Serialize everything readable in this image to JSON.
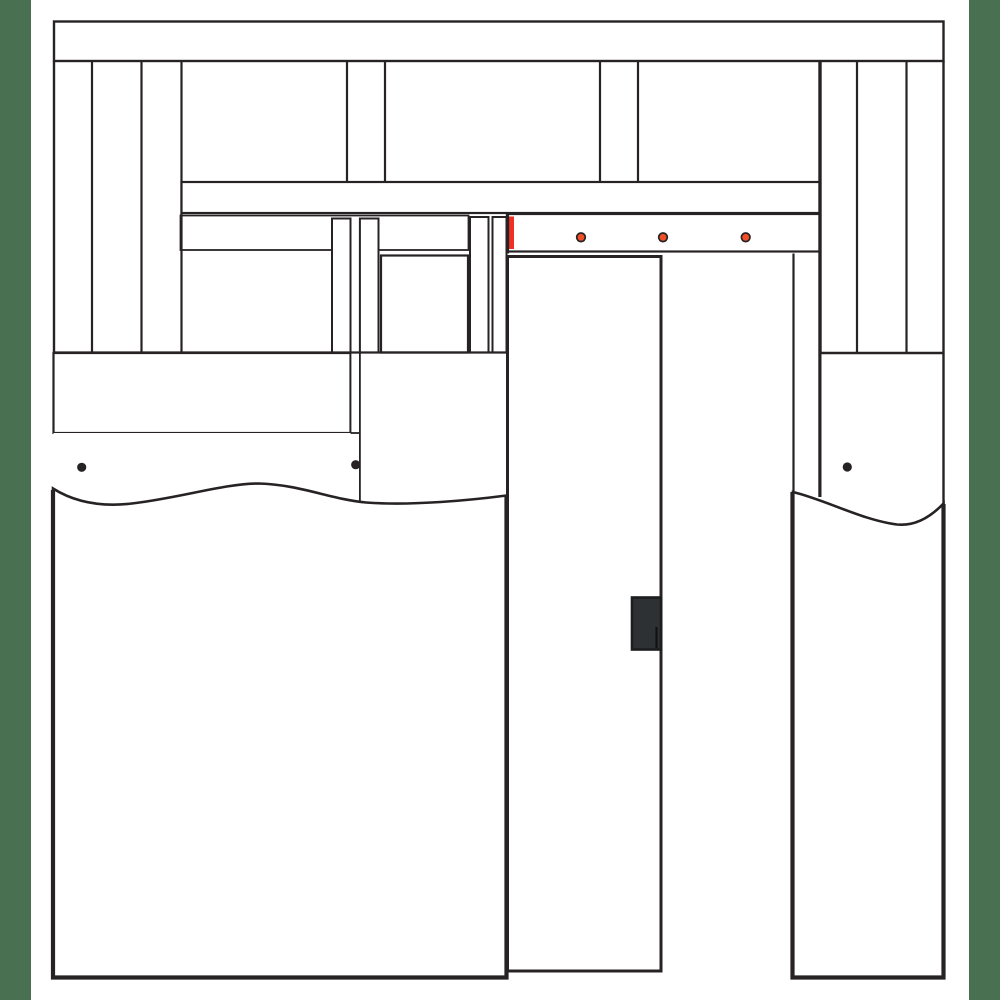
{
  "meta": {
    "description": "Pocket door frame installation illustration: wall framing with top plate, cripple studs and header, red highlighted pocket-frame header piece, screw-fastened door track, split pocket studs, hung door slab with recessed pull, and partially installed drywall shown with break lines",
    "visible_text": []
  },
  "canvas": {
    "width": 1000,
    "height": 1000,
    "background": "#ffffff"
  },
  "colors": {
    "line": "#272324",
    "highlight_red": "#EE3124",
    "screw_orange": "#EF4F27",
    "door_gray": "#E9EAEC",
    "panel_gray": "#E8E9EB",
    "handle_dark": "#2D3134",
    "handle_edge": "#1B1D1F",
    "frame_green": "#4A7052",
    "drywall_white": "#FFFFFF"
  },
  "fasteners": {
    "track_screws": {
      "style": {
        "r": 4.3,
        "stroke_width": 1.7
      },
      "points": [
        {
          "cx": 581,
          "cy": 237.3
        },
        {
          "cx": 663,
          "cy": 237.3
        },
        {
          "cx": 745.7,
          "cy": 237.3
        }
      ]
    },
    "drywall_nails": {
      "style": {
        "r": 4.6
      },
      "points": [
        {
          "cx": 81.7,
          "cy": 467.3
        },
        {
          "cx": 355.7,
          "cy": 464.7
        },
        {
          "cx": 847.3,
          "cy": 467
        }
      ]
    }
  }
}
